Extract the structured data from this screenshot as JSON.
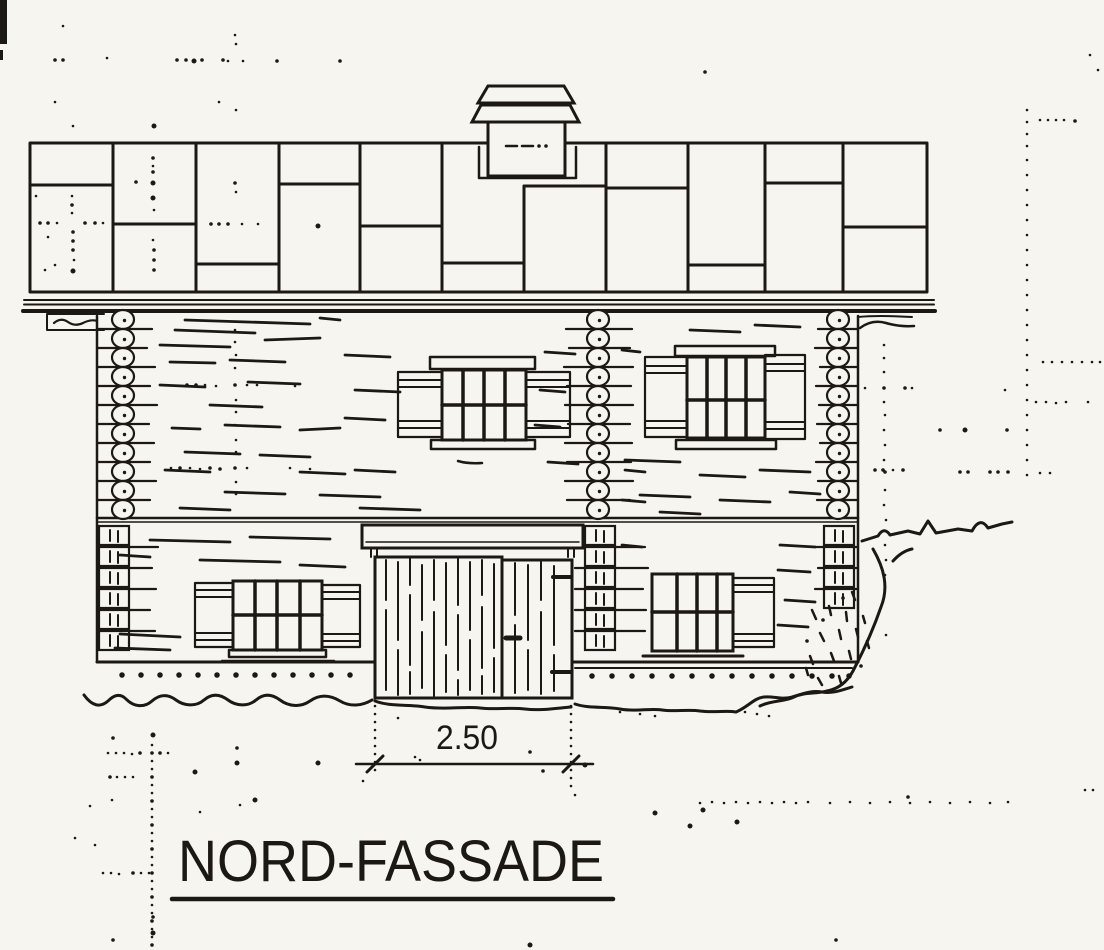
{
  "drawing": {
    "title": "NORD-FASSADE",
    "dimension": {
      "label": "2.50"
    },
    "colors": {
      "ink": "#1c1813",
      "paper": "#f7f5f0"
    },
    "elements": [
      "chimney",
      "shingled-roof",
      "eaves-fascia",
      "log-wall",
      "corner-log-ends",
      "window-upper-left",
      "window-upper-right",
      "window-lower-left",
      "window-lower-right",
      "door-canopy",
      "barn-door",
      "entry-door",
      "foundation",
      "ground-line",
      "terrain-slope",
      "gravel-mound",
      "dimension-line",
      "scan-noise"
    ]
  }
}
